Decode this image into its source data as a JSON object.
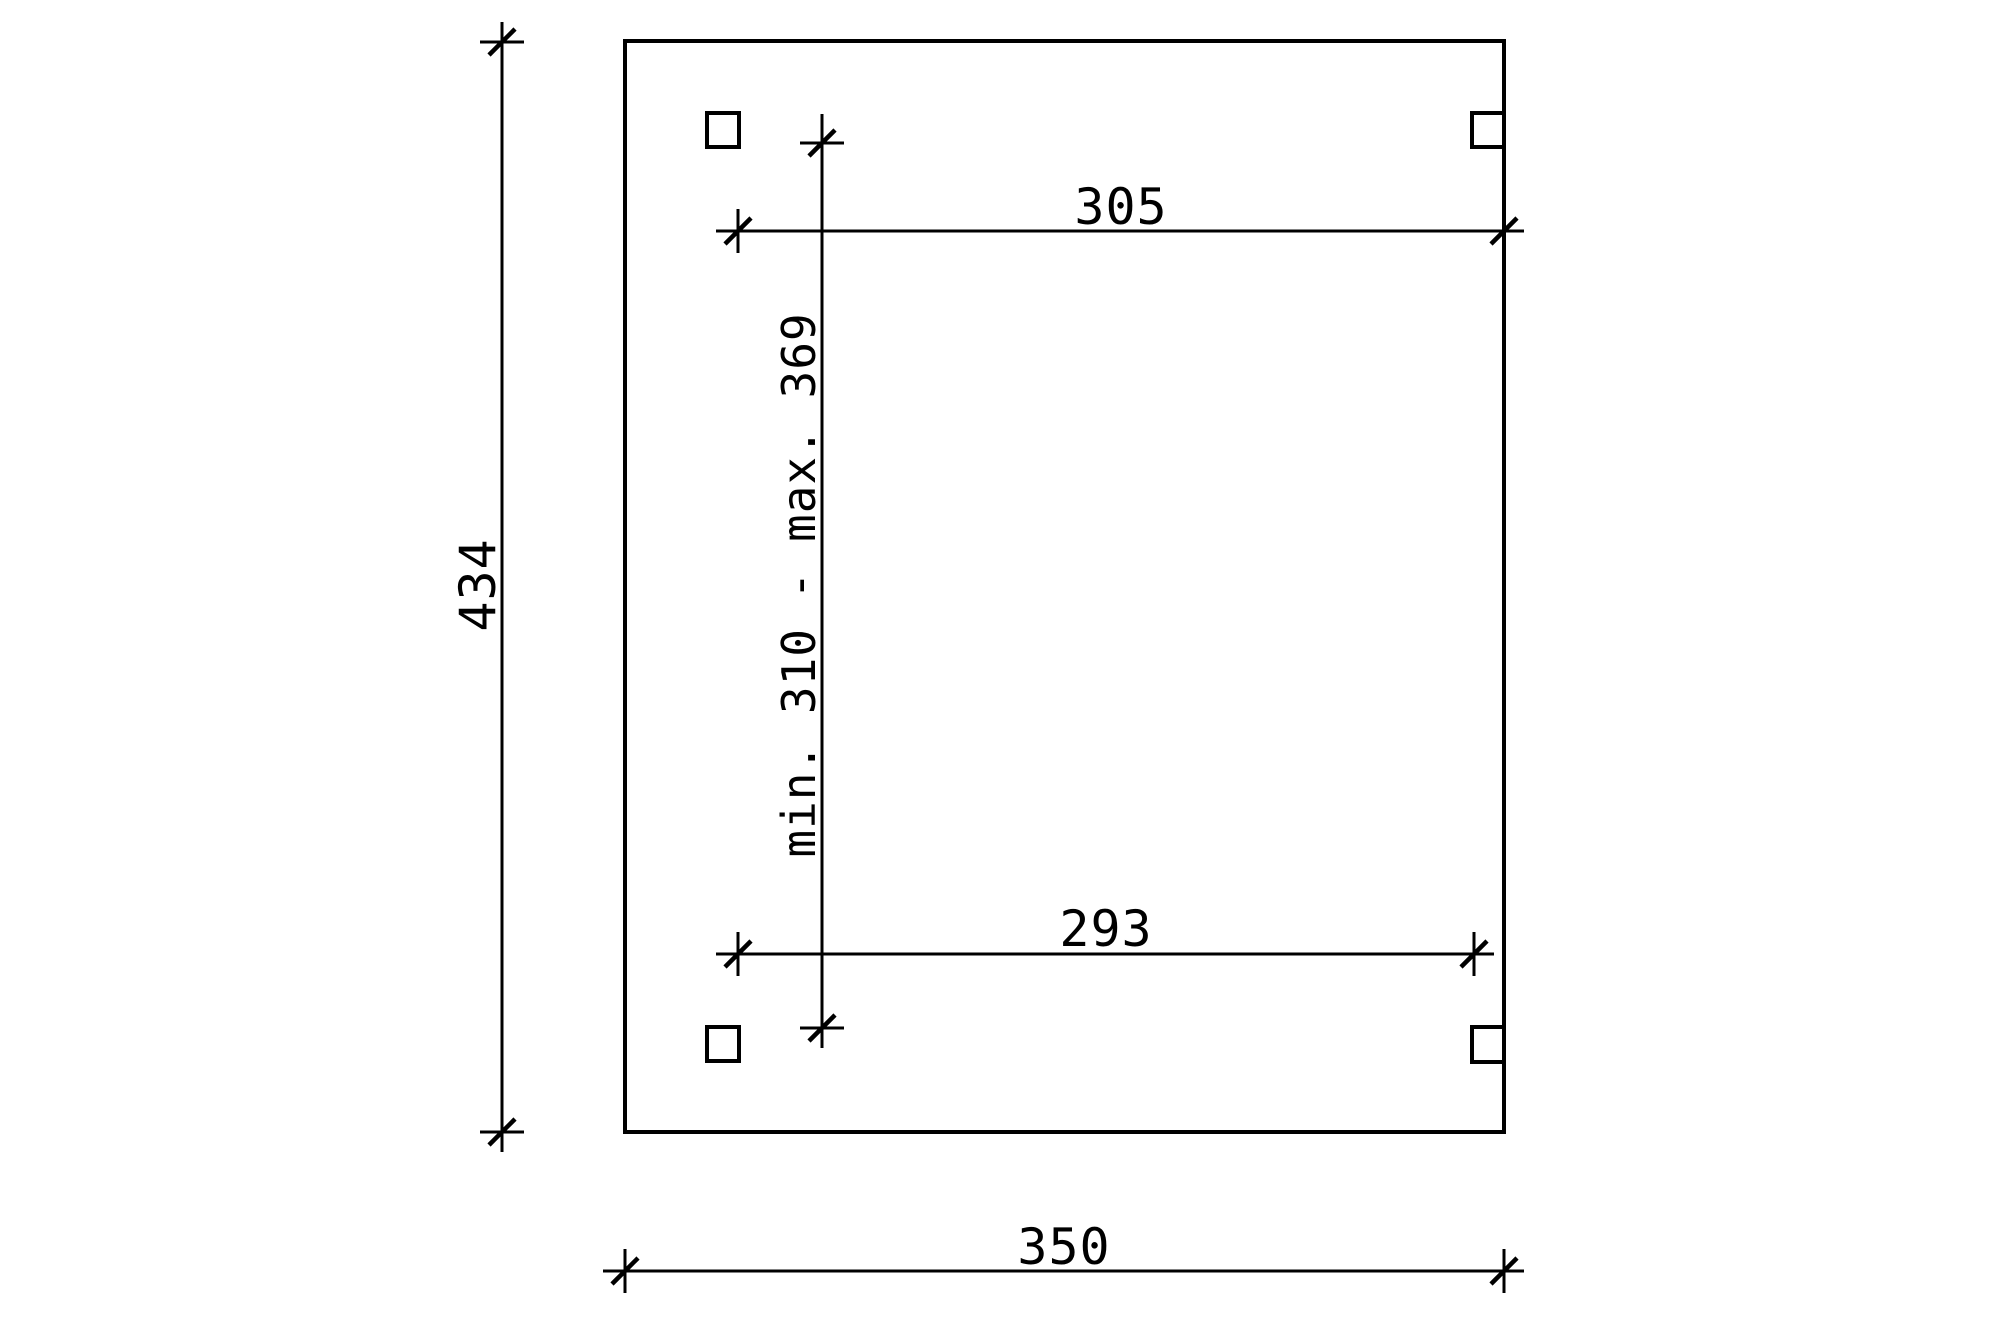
{
  "drawing": {
    "background_color": "#ffffff",
    "line_color": "#000000",
    "dimensions": {
      "height_left": "434",
      "width_top": "305",
      "width_inner": "293",
      "width_bottom": "350",
      "post_spacing": "min. 310 - max. 369"
    }
  }
}
